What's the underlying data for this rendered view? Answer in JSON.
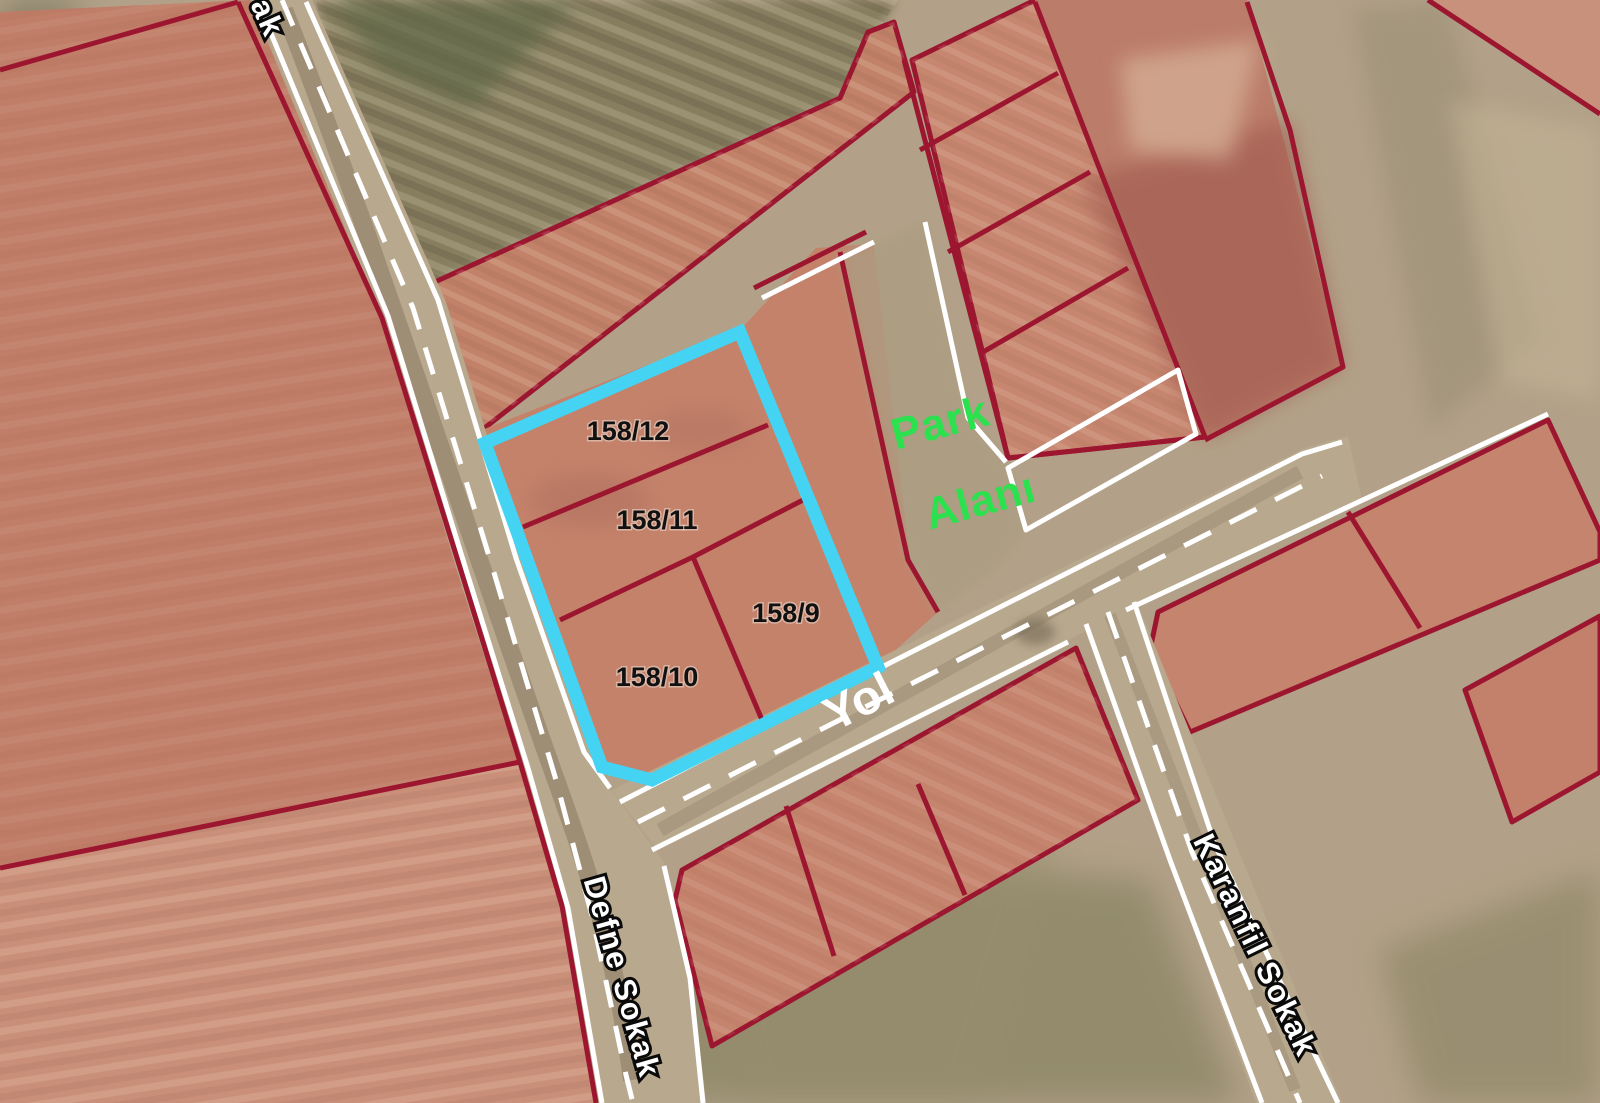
{
  "map": {
    "type": "cadastral-satellite-map",
    "highlighted_block": {
      "parcels": [
        {
          "id": "158/12"
        },
        {
          "id": "158/11"
        },
        {
          "id": "158/9"
        },
        {
          "id": "158/10"
        }
      ]
    },
    "park": {
      "label_lines": [
        "Park",
        "Alanı"
      ]
    },
    "roads": {
      "main_label": "Yol",
      "street_left": "Defne Sokak",
      "street_right": "Karanfil Sokak",
      "street_top_partial": "ak"
    },
    "colors": {
      "highlight_border": "#44D3F2",
      "parcel_boundary": "#9C1630",
      "park_label": "#2BE14E",
      "road_label": "#FFFFFF",
      "parcel_label": "#111111",
      "road_edge_line": "#FFFFFF"
    }
  }
}
